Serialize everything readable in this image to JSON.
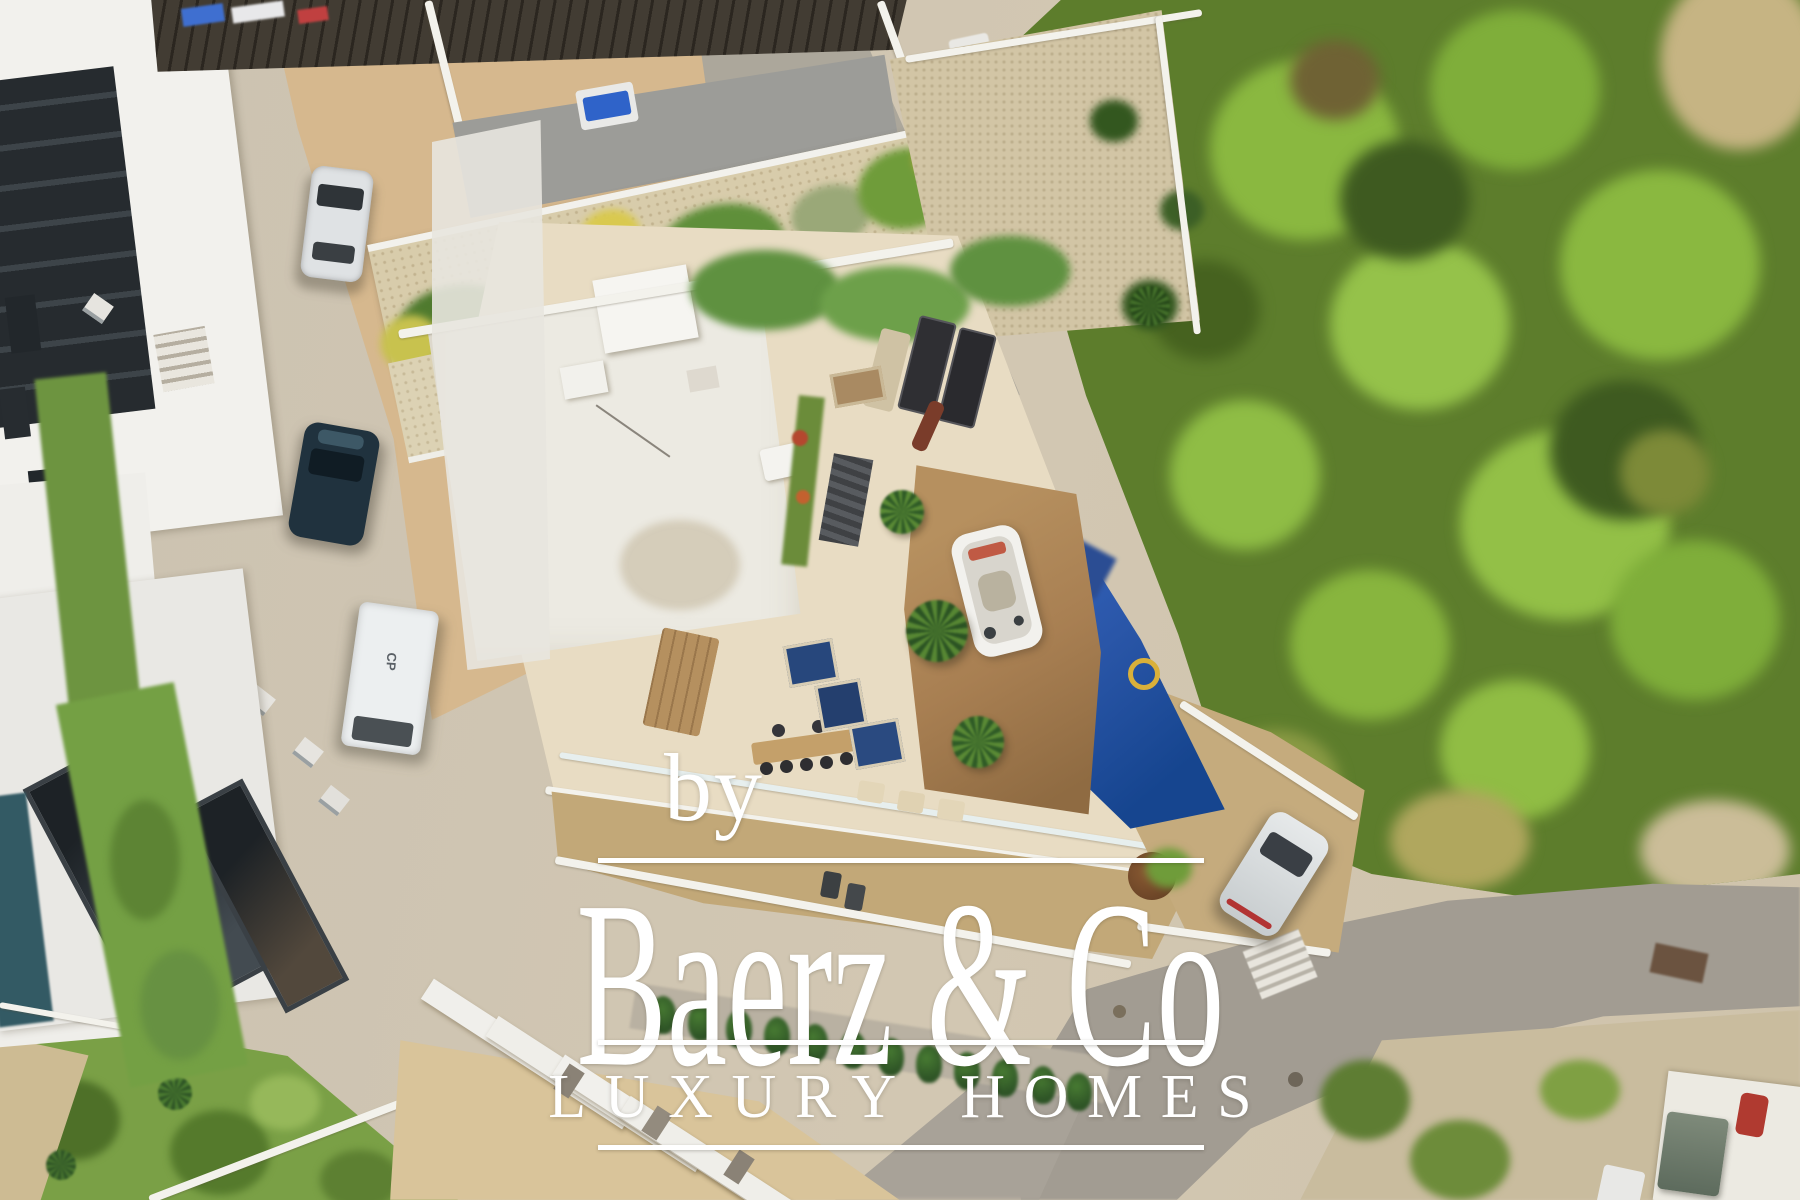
{
  "watermark": {
    "credit_prefix": "by",
    "brand_name": "Baerz & Co",
    "tagline": "LUXURY HOMES",
    "color": "#ffffff"
  },
  "scene": {
    "van_marking": "CP"
  },
  "palette": {
    "watermark_white": "#ffffff",
    "forest_green": "#5d7d2c",
    "forest_light": "#8ab840",
    "grass_green": "#7aa046",
    "hedge_green": "#2e5426",
    "terrace_beige": "#e8dcc3",
    "roof_white": "#eceae2",
    "deck_wood": "#a87f52",
    "pool_tarp_blue": "#2a56a8",
    "plunge_blue": "#27477c",
    "cobble_tan": "#c2a878",
    "sand_tan": "#d6b88e",
    "street_concrete": "#cbc2b1",
    "asphalt_gray": "#a29c92",
    "dark_roof": "#423c33",
    "car_silver": "#dfe2e4",
    "car_navy": "#20323e",
    "van_white": "#eceff0",
    "autumn_red": "#b5542d",
    "planter_yellow": "#c8c24e"
  }
}
